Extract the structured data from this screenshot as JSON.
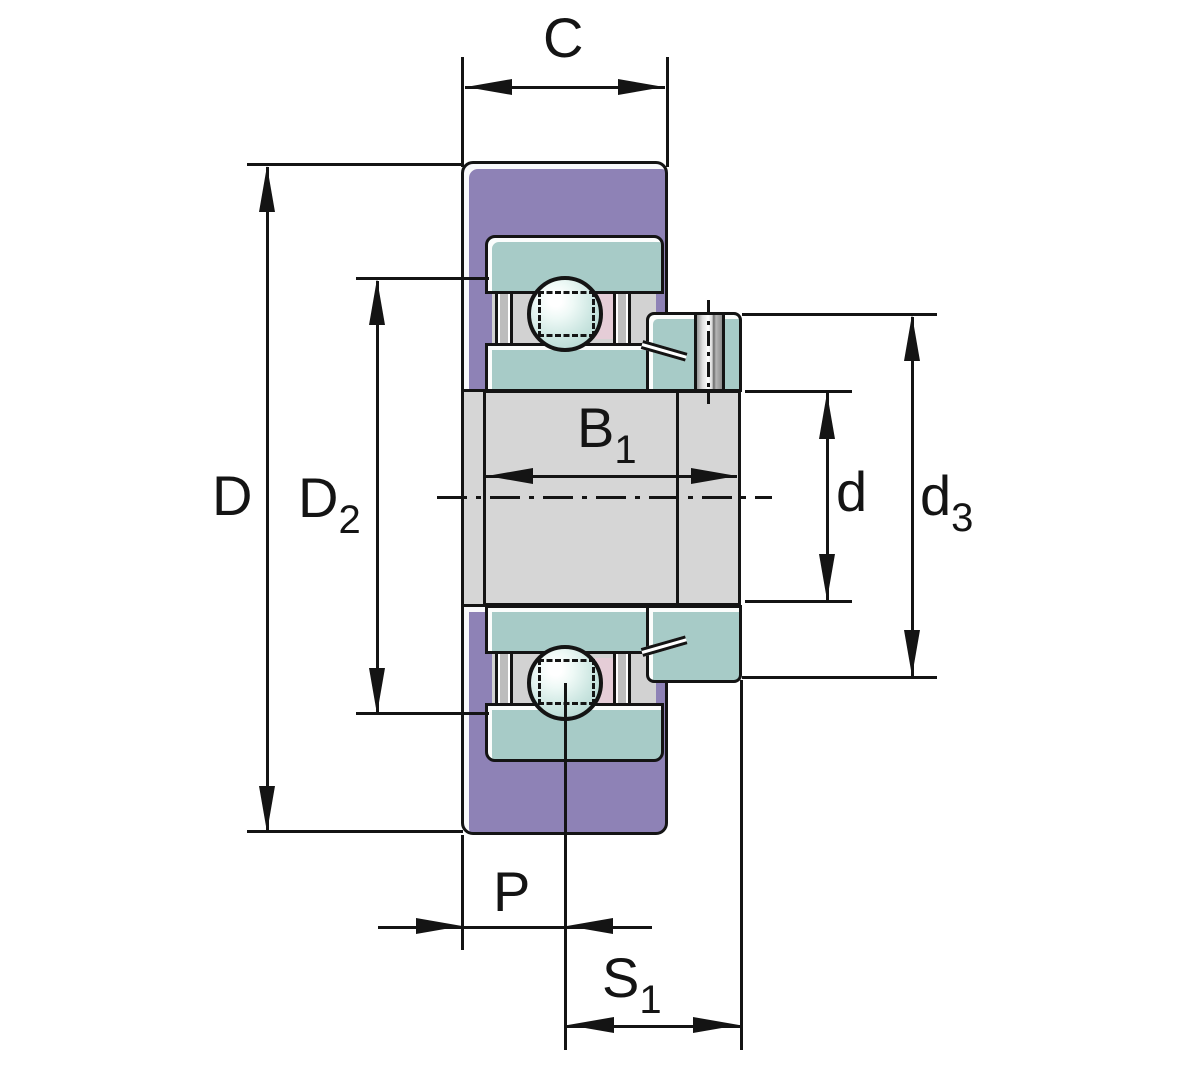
{
  "diagram": {
    "kind": "radial-insert-ball-bearing-sectional-drawing",
    "dimension_labels": {
      "c": "C",
      "D": "D",
      "D2": {
        "main": "D",
        "sub": "2"
      },
      "B1": {
        "main": "B",
        "sub": "1"
      },
      "d": "d",
      "d3": {
        "main": "d",
        "sub": "3"
      },
      "P": "P",
      "S1": {
        "main": "S",
        "sub": "1"
      }
    },
    "colors": {
      "outer_ring_purple": "#8e82b6",
      "bearing_ring_teal": "#a7cbc7",
      "shaft_gray": "#d6d6d6",
      "interior_gray": "#d2d2d2",
      "cage_pink": "#e5cdd7",
      "outline_black": "#141414",
      "highlight_white": "#ffffff",
      "background": "#ffffff"
    }
  }
}
